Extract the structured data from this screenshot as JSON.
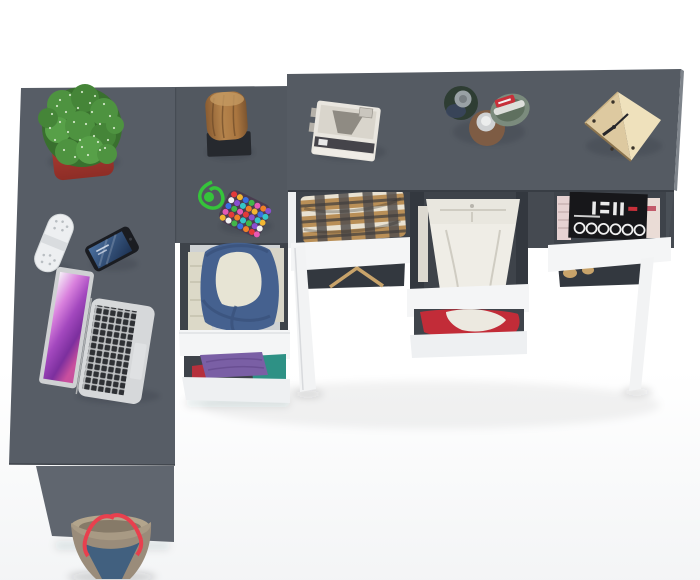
{
  "meta": {
    "kind": "product-render",
    "view": "top-down view of grey corner desk with open white drawers"
  },
  "palette": {
    "background": "#ffffff",
    "desk_left_top": "#575d66",
    "cabinet_top": "#525860",
    "desk_right_top": "#555b63",
    "desk_side_panel": "#60666f",
    "desk_right_side": "#4a5057",
    "side_panel_white": "#eef0f1",
    "drawer_front": "#f4f5f6",
    "drawer_front_lower": "#eef0f2",
    "drawer_interior": "#3e434a",
    "drawer_cavity": "#33383f",
    "leg_white": "#f2f3f4",
    "pot_red": "#b23c32",
    "cactus_green": "#4e9340",
    "cactus_speckle": "#e4f2da",
    "stump_brown": "#a9753f",
    "stand_black": "#26292e",
    "cord_green": "#35c43a",
    "pouch_dark": "#4a3c50",
    "bead_colors": [
      "#e33a3a",
      "#f2b632",
      "#3a6fe0",
      "#41b649",
      "#e659b5",
      "#f07f28",
      "#8a4fd0",
      "#f2f2f2",
      "#35c7c7"
    ],
    "gadget_white": "#edeff1",
    "phone_black": "#1a1c21",
    "laptop_silver": "#d6d8da",
    "trackpad": "#dfe1e3",
    "backpack_blue": "#45618f",
    "cloth_cream": "#e7e4d4",
    "clothes_left_cream": "#dcd9c8",
    "shirt_purple": "#7a5fa5",
    "shirt_teal": "#2e9185",
    "shirt_red": "#b5303c",
    "plaid_tan": "#b98f57",
    "plaid_dark": "#54504f",
    "plaid_cream": "#e9e2d2",
    "pants_white": "#efede6",
    "pants_band": "#e9e7df",
    "red_garment": "#c22c38",
    "white_cloth": "#ece9e0",
    "magazine_black": "#17171a",
    "magazine_pages_left": "#e6d2d2",
    "magazine_pages_right": "#eadcd6",
    "hanger_tan": "#c8a36a",
    "camera_white": "#e9e6df",
    "camera_inner": "#8f8b83",
    "perfume_green_dark": "#2e3d33",
    "perfume_cap_gray": "#99a1a5",
    "perfume_amber": "#7e5c44",
    "perfume_cap_silver": "#cfd1d3",
    "tin_green": "#7b8b7d",
    "tin_red": "#c8303a",
    "clock_wood": "#ddc9a0",
    "clock_wood_light": "#efe1bc",
    "bag_taupe": "#9a8c7a",
    "bag_denim": "#41607f",
    "bag_red": "#e8404e",
    "bag_interior": "#b3a58c"
  },
  "scene": {
    "items": [
      {
        "name": "left-desk",
        "desc": "grey desk return, top-down"
      },
      {
        "name": "corner-cabinet",
        "desc": "grey corner drawer unit with two open white drawers"
      },
      {
        "name": "right-desk",
        "desc": "grey desk with three open white drawers and splayed white legs"
      },
      {
        "name": "cactus-plant",
        "desc": "green succulent in red square planter"
      },
      {
        "name": "tree-stump-decor",
        "desc": "wooden stump on black stand"
      },
      {
        "name": "bead-pouch",
        "desc": "multicolour beaded pouch with green cord"
      },
      {
        "name": "white-gadget",
        "desc": "white capsule speaker / remote"
      },
      {
        "name": "smartphone",
        "desc": "black smartphone, blue wallpaper"
      },
      {
        "name": "laptop",
        "desc": "open silver laptop with purple wallpaper"
      },
      {
        "name": "retro-camera",
        "desc": "white vintage instant camera"
      },
      {
        "name": "perfume-bottles",
        "desc": "three round cosmetic bottles"
      },
      {
        "name": "cube-clock",
        "desc": "plywood cube clock"
      },
      {
        "name": "drawer-backpack",
        "desc": "drawer with blue backpack and cream cloth"
      },
      {
        "name": "drawer-folded-shirts",
        "desc": "drawer with purple, teal and red shirts"
      },
      {
        "name": "drawer-plaid-shirt",
        "desc": "drawer with brown plaid shirt"
      },
      {
        "name": "drawer-white-trousers",
        "desc": "drawer with folded white trousers"
      },
      {
        "name": "drawer-red-garment",
        "desc": "drawer with red garment and white cloth"
      },
      {
        "name": "drawer-magazines",
        "desc": "drawer with black magazine and pink pages"
      },
      {
        "name": "clothes-hanger",
        "desc": "wooden hanger under drawer"
      },
      {
        "name": "tote-bag",
        "desc": "denim and taupe tote bag with red straps"
      }
    ]
  }
}
